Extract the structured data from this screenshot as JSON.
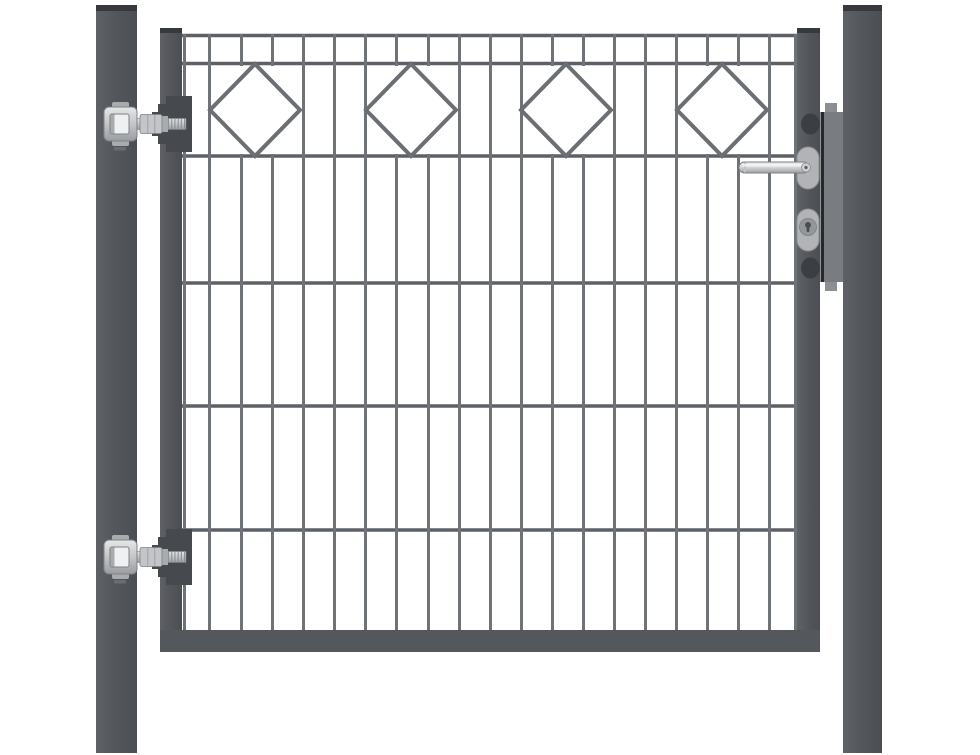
{
  "meta": {
    "description": "Anthracite grey ornamental metal garden gate: double-rod mesh panel with a band of four diamond ornaments at the top, mounted between two square posts, with two adjustable hinges on the left and a lock with lever handle and key cylinder on the right",
    "width": 980,
    "height": 755,
    "background": "#ffffff"
  },
  "colors": {
    "steel_light": "#5d6065",
    "steel": "#54575c",
    "steel_shade": "#494c51",
    "cap": "#36393d",
    "bar": "#6f7277",
    "wire": "#5d6066",
    "diamond": "#6b6e73",
    "block": "#46494e",
    "silver_hi": "#e6e7e9",
    "silver": "#c3c5c8",
    "silver_mid": "#a9acaf",
    "silver_edge": "#7e8184",
    "thread": "#8d9094",
    "bracket_hole": "#eef0f1",
    "housing": "#797c80",
    "housing_tab": "#8b8e92",
    "lock_plate": "#26282b",
    "bump": "#3b3e42",
    "escutcheon": "#b1b3b6",
    "escutcheon_edge": "#8f9295",
    "cyl_inner": "#94979a",
    "cyl_ring": "#7f8286",
    "keyhole": "#4a4d51",
    "chrome_hi": "#eceded",
    "chrome_lo": "#9ea1a4",
    "chrome_edge": "#7d8083"
  },
  "posts": {
    "left": {
      "x": 96,
      "y": 5,
      "w": 41,
      "h": 748
    },
    "right": {
      "x": 843,
      "y": 5,
      "w": 39,
      "h": 748
    },
    "cap_h": 6
  },
  "frame": {
    "left": {
      "x": 160,
      "y": 28,
      "w": 22,
      "h": 624
    },
    "right": {
      "x": 797,
      "y": 28,
      "w": 23,
      "h": 624
    },
    "bottom": {
      "x": 160,
      "y": 630,
      "w": 660,
      "h": 22
    },
    "cap_h": 5
  },
  "mesh": {
    "x": 182,
    "w": 615,
    "bar_w": 3,
    "wire_h": 3.5,
    "bar_top": 34,
    "bar_bottom": 631,
    "band_top": 66,
    "band_bottom": 154,
    "wire_ys": [
      35.5,
      63.5,
      156,
      283,
      406,
      530
    ],
    "bar_xs": [
      183,
      208,
      240,
      271,
      302,
      333,
      364,
      395,
      427,
      458,
      489,
      520,
      551,
      582,
      613,
      644,
      675,
      706,
      737,
      768,
      794
    ]
  },
  "diamonds": {
    "centers_x": [
      255,
      411,
      566,
      722
    ],
    "cy": 110,
    "half_w": 45,
    "half_h": 46,
    "stroke_w": 4,
    "skip_threshold": 42
  },
  "hinges": {
    "centers_y": [
      124,
      557
    ]
  },
  "lock": {
    "housing": {
      "x": 823,
      "y": 112,
      "w": 24,
      "h": 170
    },
    "plate": {
      "x": 820.5,
      "y": 112,
      "w": 3.5,
      "h": 170
    },
    "tab_top": {
      "x": 825,
      "y": 103,
      "w": 12,
      "h": 10
    },
    "tab_bottom": {
      "x": 825,
      "y": 281,
      "w": 12,
      "h": 10
    },
    "bump_top": {
      "cx": 810.5,
      "cy": 124,
      "rx": 9.5,
      "ry": 10.5
    },
    "bump_bottom": {
      "cx": 810.5,
      "cy": 268,
      "rx": 9.5,
      "ry": 10.5
    },
    "handle_escutcheon": {
      "x": 797,
      "y": 147,
      "w": 22,
      "h": 42,
      "rx": 11
    },
    "cylinder_escutcheon": {
      "x": 797,
      "y": 209,
      "w": 22,
      "h": 42,
      "rx": 11
    },
    "handle": {
      "x": 739,
      "y": 162,
      "w": 70,
      "h": 11,
      "rx": 5.5,
      "pivot_cx": 806,
      "pivot_cy": 167.5
    },
    "cylinder": {
      "cx": 808,
      "cy": 227,
      "r": 8.5,
      "key_cy": 225,
      "key_r": 3
    }
  }
}
